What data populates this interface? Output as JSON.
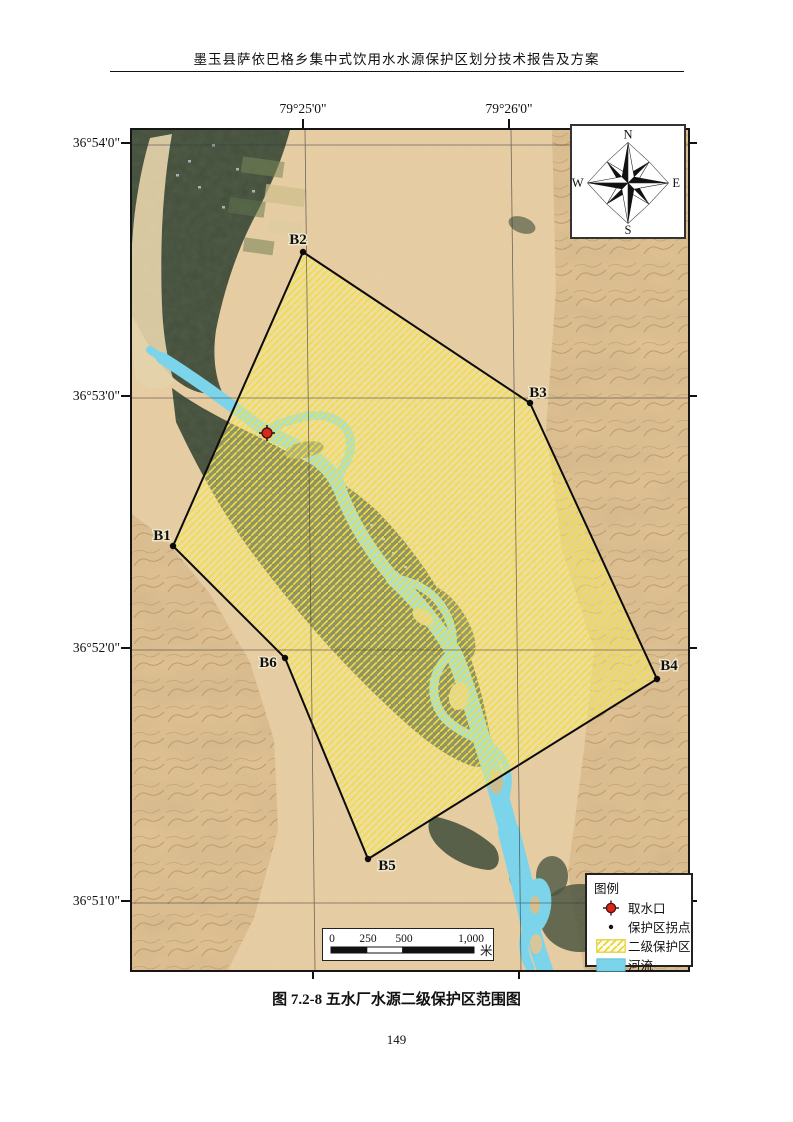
{
  "page": {
    "header_title": "墨玉县萨依巴格乡集中式饮用水水源保护区划分技术报告及方案",
    "caption": "图 7.2-8  五水厂水源二级保护区范围图",
    "page_number": "149"
  },
  "map": {
    "lon_labels": [
      "79°25'0\"",
      "79°26'0\""
    ],
    "lat_labels": [
      "36°54'0\"",
      "36°53'0\"",
      "36°52'0\"",
      "36°51'0\""
    ],
    "boundary_points": [
      "B1",
      "B2",
      "B3",
      "B4",
      "B5",
      "B6"
    ],
    "compass": {
      "n": "N",
      "e": "E",
      "s": "S",
      "w": "W"
    }
  },
  "legend": {
    "title": "图例",
    "items": [
      {
        "label": "取水口",
        "marker": "intake-marker"
      },
      {
        "label": "保护区拐点",
        "marker": "vertex-dot"
      },
      {
        "label": "二级保护区",
        "marker": "hatch-swatch"
      },
      {
        "label": "河流",
        "marker": "water-swatch"
      }
    ]
  },
  "scalebar": {
    "ticks": [
      "0",
      "250",
      "500",
      "1,000"
    ],
    "unit": "米"
  },
  "colors": {
    "river": "#7bd4ea",
    "hatch_line": "#eedd3f",
    "vegetation": "#45503d",
    "sand": "#e7cda2",
    "intake_red": "#d82819"
  }
}
